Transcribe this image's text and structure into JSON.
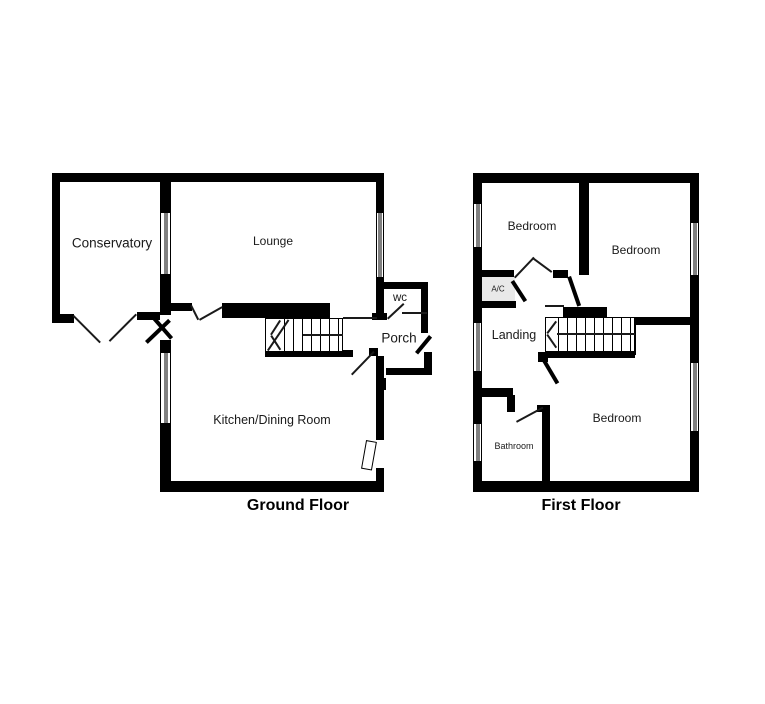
{
  "colors": {
    "wall": "#000000",
    "background": "#ffffff",
    "ac_closet_fill": "#e9e9e9"
  },
  "floors": [
    {
      "title": "Ground Floor",
      "rooms": [
        {
          "id": "conservatory",
          "label": "Conservatory"
        },
        {
          "id": "lounge",
          "label": "Lounge"
        },
        {
          "id": "wc",
          "label": "wc"
        },
        {
          "id": "porch",
          "label": "Porch"
        },
        {
          "id": "kitchen-dining",
          "label": "Kitchen/Dining Room"
        }
      ]
    },
    {
      "title": "First Floor",
      "rooms": [
        {
          "id": "bedroom-front-left",
          "label": "Bedroom"
        },
        {
          "id": "bedroom-rear-right",
          "label": "Bedroom"
        },
        {
          "id": "ac-cupboard",
          "label": "A/C"
        },
        {
          "id": "landing",
          "label": "Landing"
        },
        {
          "id": "bathroom",
          "label": "Bathroom"
        },
        {
          "id": "bedroom-bottom-right",
          "label": "Bedroom"
        }
      ]
    }
  ]
}
